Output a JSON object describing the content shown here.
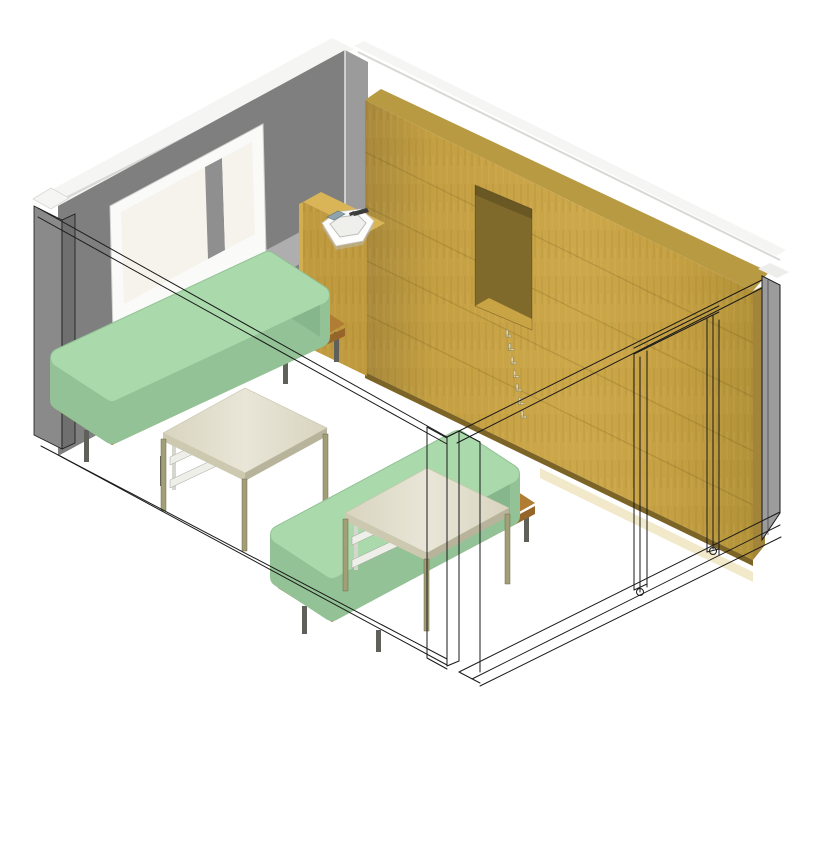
{
  "view": {
    "type": "3d-isometric-room-view",
    "background": "#ffffff"
  },
  "scene": {
    "objects": [
      "left-wall-cut",
      "back-wall",
      "window",
      "window-sill-band",
      "corner-wall",
      "sink-cabinet",
      "corner-basin",
      "faucet",
      "soap-dish",
      "wardrobe-wood-wall",
      "wall-niche",
      "coat-hooks",
      "door-frame-wireframe",
      "right-wall-cut",
      "bed-1",
      "bed-2",
      "overbed-table-1",
      "overbed-table-2",
      "under-table-shelf-1",
      "under-table-shelf-2",
      "section-cut-outline",
      "floor"
    ]
  },
  "colors": {
    "outline": "#1a1a1a",
    "wallFace": "#7f7f7f",
    "leftColFace": "#8a8a8a",
    "leftColSide": "#6f6f6f",
    "capWhite": "#f5f5f3",
    "capShade": "#d8d8d6",
    "cornerReturn": "#9b9b9b",
    "glass": "#f5f3ec",
    "frameWhite": "#fafaf8",
    "mullion": "#8f8f8f",
    "sillBand": "#aeaeae",
    "sillLedge": "#dcdcda",
    "woodTopFace": "#b89a43",
    "woodEndFace": "#a2843a",
    "woodBaseShadow": "#7c6326",
    "woodDark": "#a8893c",
    "wood": "#c5a042",
    "woodLight": "#cda84a",
    "woodDeep": "#b29238",
    "nicheBack": "#7f692b",
    "nicheShade": "rgba(0,0,0,0.16)",
    "nicheFloor": "#c9a445",
    "capRight": "#ededeb",
    "rightWallCut": "#9c9c9c",
    "floorGlow": "#e6d79e",
    "cabinetTop": "#d9b557",
    "cabinetFront": "#c09a3e",
    "cabinetSide": "#d2ae50",
    "basin": "#fdfdfc",
    "basinInner": "#efefec",
    "basinRim": "#bdbdb9",
    "faucet": "#3c3c3c",
    "soap": "#8fa3ad",
    "mattressTop": "#aad9ab",
    "mattressSide": "#92c295",
    "mattressFoot": "#86b68b",
    "deckTop": "#b17c33",
    "deckEdge": "#96652a",
    "bedLeg": "#60605a",
    "tableTopMid": "#e9e6d8",
    "tableTopEdge": "#d8d4bf",
    "tableSideL": "#cdc9b1",
    "tableSideR": "#b8b49b",
    "tableLeg": "#a29e76",
    "tableLegDark": "#6f6b4d",
    "shelfSlat": "#efefe9",
    "shelfPost": "#d6d6ce",
    "shelfShadow": "#a3a39b",
    "hookFill": "#ddd3a4",
    "hookStroke": "#8e8254",
    "plankLine": "rgba(90,70,20,0.18)"
  }
}
